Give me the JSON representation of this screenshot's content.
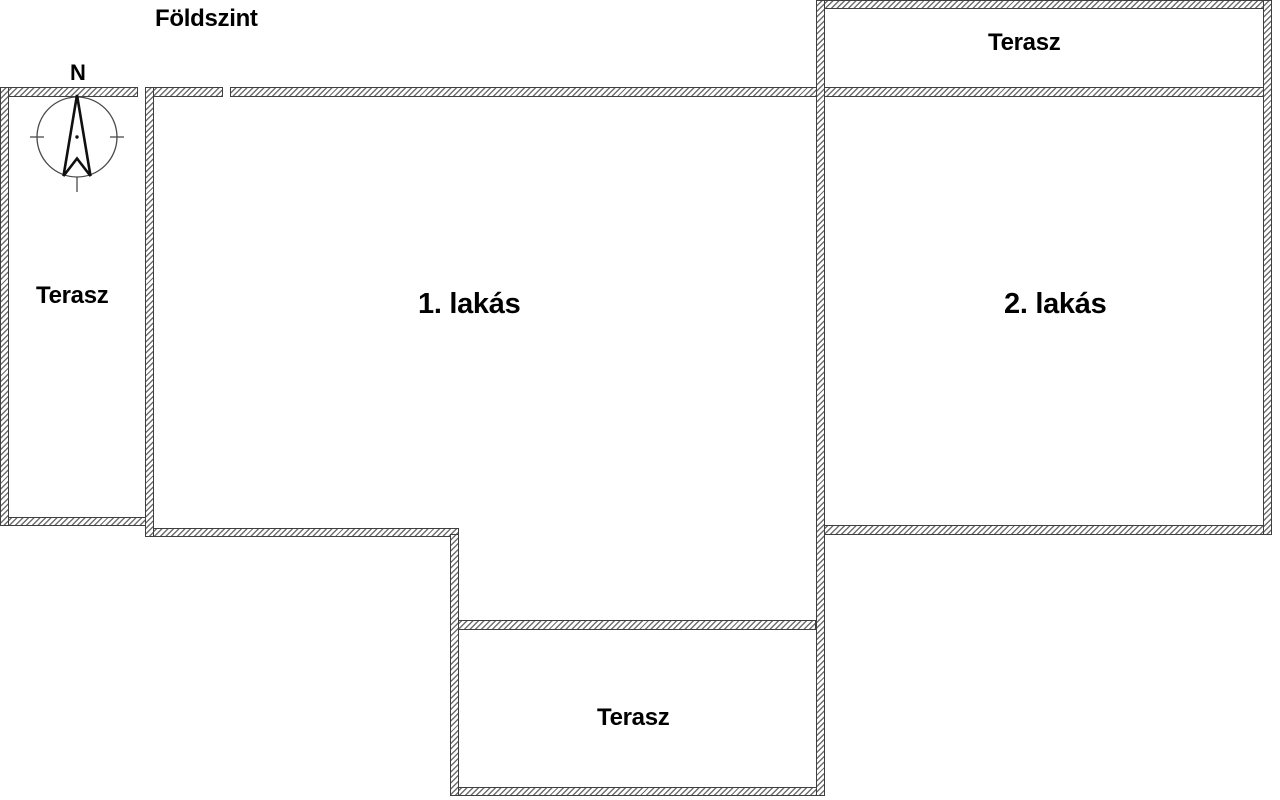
{
  "title": "Földszint",
  "compass": {
    "north_label": "N"
  },
  "labels": {
    "terrace_left": "Terasz",
    "terrace_top_right": "Terasz",
    "terrace_bottom": "Terasz",
    "apartment_1": "1. lakás",
    "apartment_2": "2. lakás"
  },
  "colors": {
    "wall_outline": "#3f3f3f",
    "wall_hatch": "#6f6f6f",
    "text": "#000000",
    "background": "#ffffff"
  }
}
